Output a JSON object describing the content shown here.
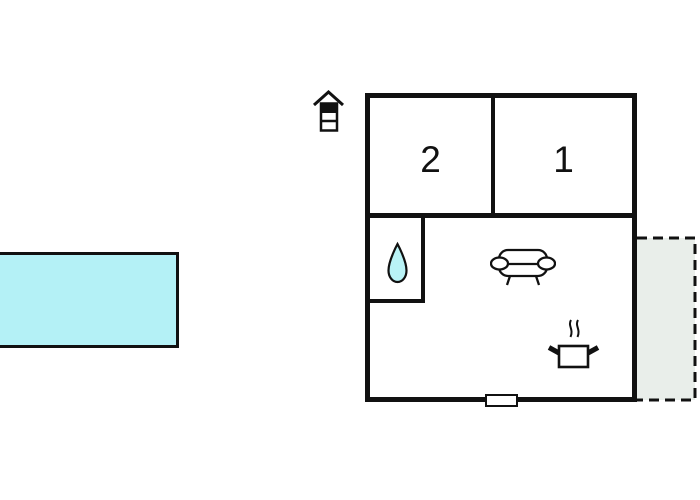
{
  "diagram": {
    "type": "floor-plan",
    "room_labels": {
      "bedroom_2": "2",
      "bedroom_1": "1"
    },
    "features": {
      "pool": "swimming-pool",
      "terrace": "terrace-dashed-area",
      "entrance_marker": "house-icon",
      "bathroom_marker": "water-drop-icon",
      "living_room_marker": "sofa-icon",
      "kitchen_marker": "cooking-pot-icon",
      "opening_marker": "window-symbol"
    },
    "colors": {
      "pool": "#b4f1f6",
      "water_drop": "#b9f3f6",
      "terrace": "#e9eeea",
      "wall": "#111111",
      "background": "#ffffff"
    }
  }
}
